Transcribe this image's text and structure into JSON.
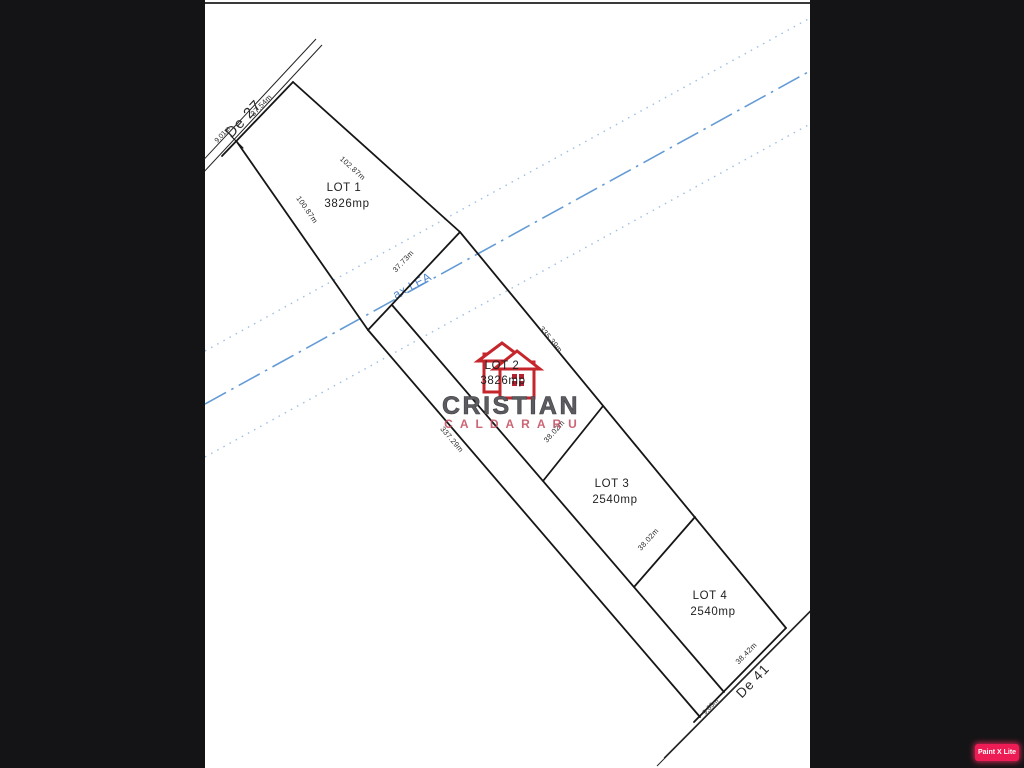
{
  "window": {
    "background": "#141416",
    "sheet_background": "#ffffff"
  },
  "plan": {
    "roads": [
      {
        "label": "De 27"
      },
      {
        "label": "De 41"
      }
    ],
    "lots": [
      {
        "label": "LOT 1",
        "area": "3826mp"
      },
      {
        "label": "LOT 2",
        "area": "3826mp"
      },
      {
        "label": "LOT 3",
        "area": "2540mp"
      },
      {
        "label": "LOT 4",
        "area": "2540mp"
      }
    ],
    "dimensions": {
      "de27_offset": "9.01m",
      "lot1_top": "37.54m",
      "lot1_ne_side": "102.87m",
      "lot1_sw_side": "100.87m",
      "lot1_bottom": "37.73m",
      "strip_ne_side": "335.39m",
      "strip_sw_side": "337.29m",
      "lot3_nw_side": "38.02m",
      "lot3_se_side": "38.02m",
      "de41_frontage": "38.42m",
      "de41_offset": "9.63m"
    },
    "power_line": {
      "label": "ax LEA",
      "axis_color": "#649bd6",
      "corridor_color": "#9dbfe6"
    },
    "line_color": "#161616"
  },
  "watermark": {
    "name_primary": "CRISTIAN",
    "name_secondary": "CALDARARU",
    "primary_color": "#5c5c60",
    "secondary_color": "#c44b5c",
    "logo_color": "#c5262c"
  },
  "editor_badge": {
    "label": "Paint X Lite"
  }
}
